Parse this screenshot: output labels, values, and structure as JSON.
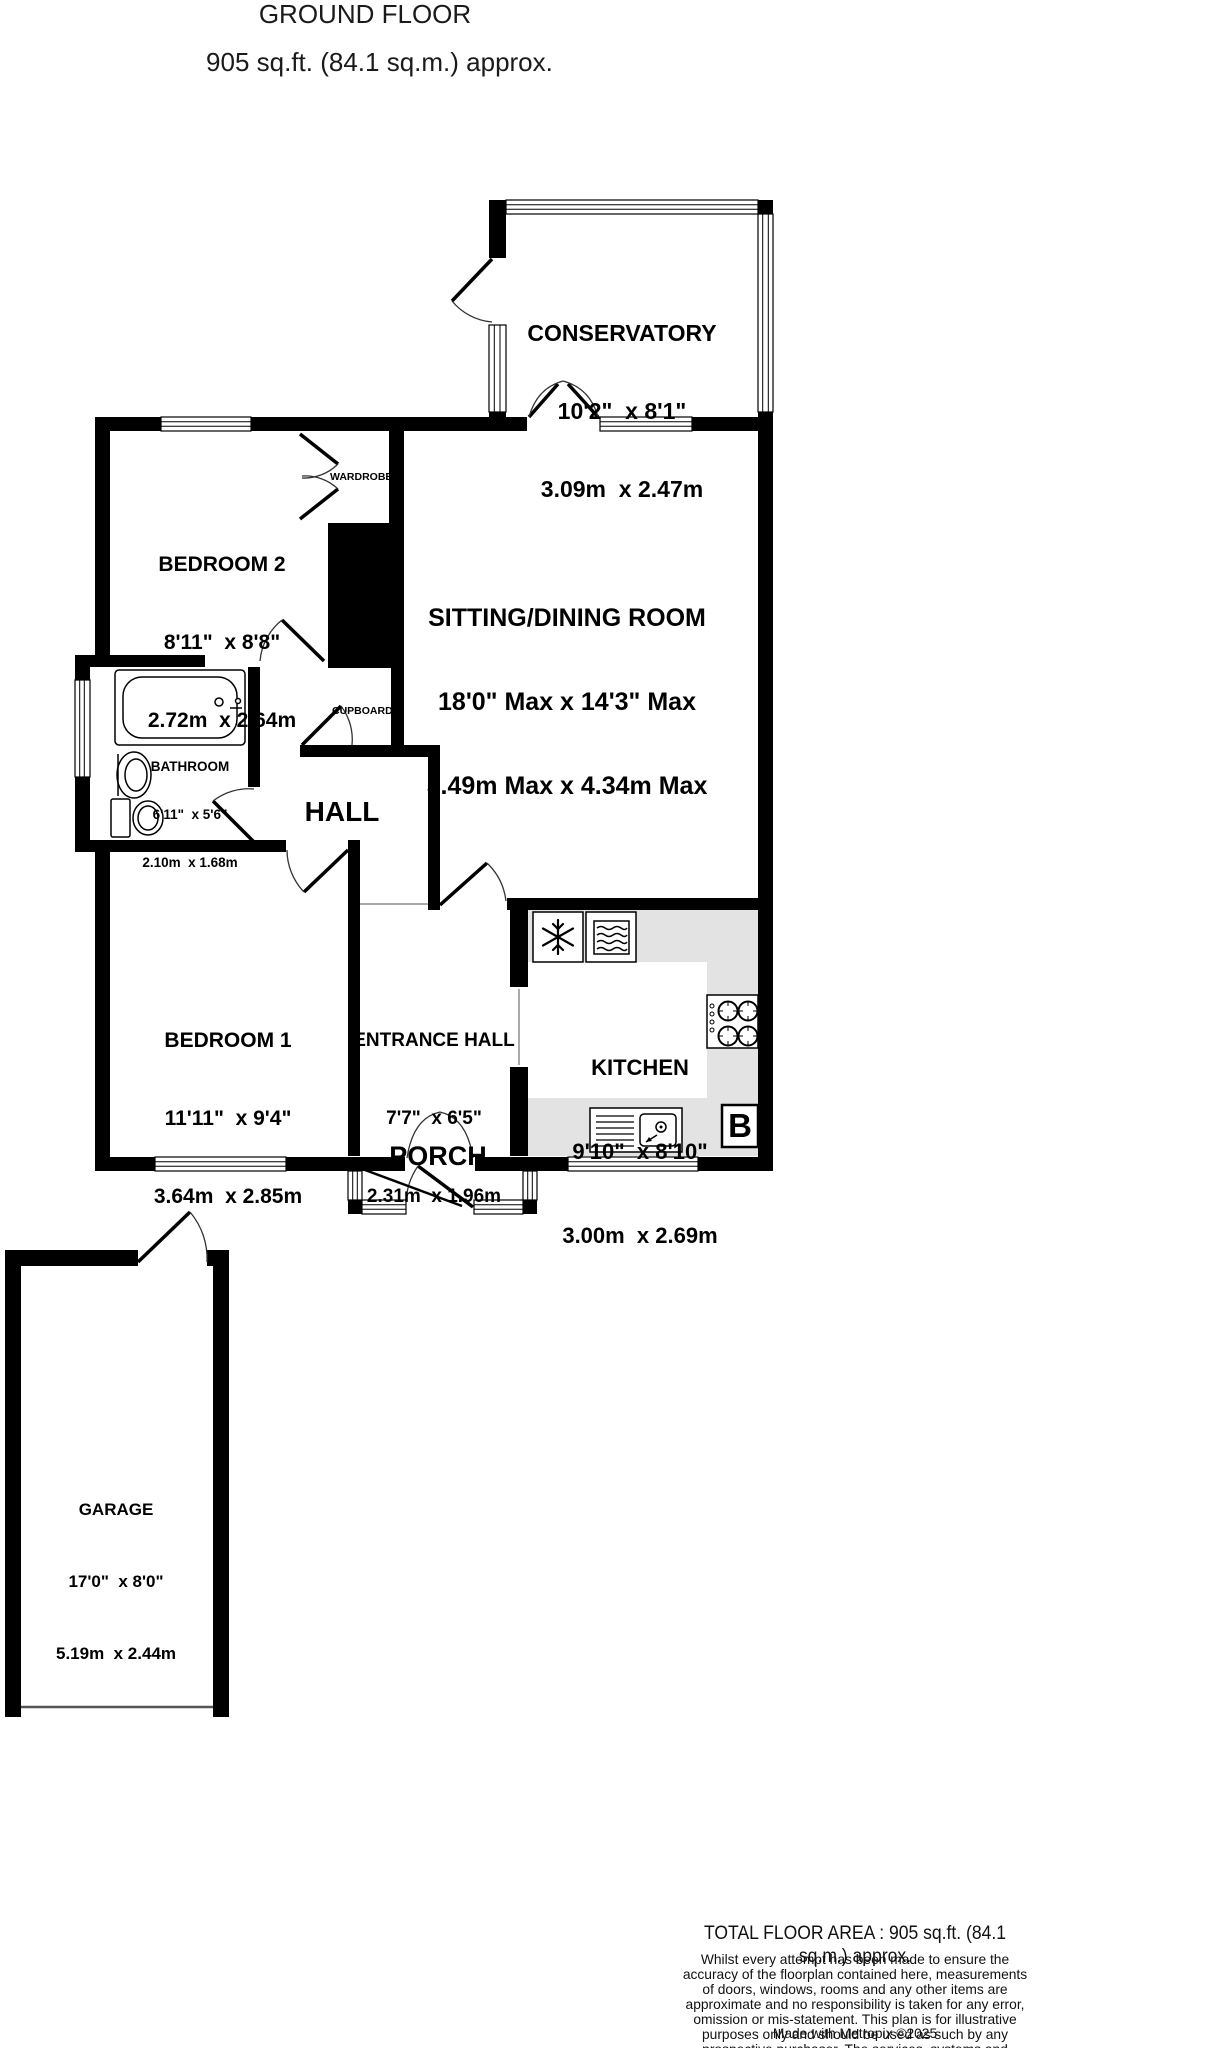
{
  "title": {
    "line1": "GROUND FLOOR",
    "line2": "905 sq.ft. (84.1 sq.m.) approx."
  },
  "rooms": {
    "conservatory": {
      "name": "CONSERVATORY",
      "imperial": "10'2\"  x 8'1\"",
      "metric": "3.09m  x 2.47m"
    },
    "bedroom2": {
      "name": "BEDROOM 2",
      "imperial": "8'11\"  x 8'8\"",
      "metric": "2.72m  x 2.64m"
    },
    "sitting_dining": {
      "name": "SITTING/DINING ROOM",
      "imperial": "18'0\" Max x 14'3\" Max",
      "metric": "5.49m Max x 4.34m Max"
    },
    "bathroom": {
      "name": "BATHROOM",
      "imperial": "6'11\"  x 5'6\"",
      "metric": "2.10m  x 1.68m"
    },
    "hall": {
      "name": "HALL"
    },
    "wardrobe": {
      "name": "WARDROBE"
    },
    "cupboard": {
      "name": "CUPBOARD"
    },
    "bedroom1": {
      "name": "BEDROOM 1",
      "imperial": "11'11\"  x 9'4\"",
      "metric": "3.64m  x 2.85m"
    },
    "entrance_hall": {
      "name": "ENTRANCE HALL",
      "imperial": "7'7\"  x 6'5\"",
      "metric": "2.31m  x 1.96m"
    },
    "kitchen": {
      "name": "KITCHEN",
      "imperial": "9'10\"  x 8'10\"",
      "metric": "3.00m  x 2.69m"
    },
    "porch": {
      "name": "PORCH"
    },
    "garage": {
      "name": "GARAGE",
      "imperial": "17'0\"  x 8'0\"",
      "metric": "5.19m  x 2.44m"
    }
  },
  "symbols": {
    "boiler": "B"
  },
  "icons": [
    "freezer-icon",
    "oven-icon",
    "hob-icon",
    "kitchen-sink-icon",
    "bath-icon",
    "basin-icon",
    "toilet-icon"
  ],
  "footer": {
    "total_area": "TOTAL FLOOR AREA : 905 sq.ft. (84.1 sq.m.) approx.",
    "disclaimer": "Whilst every attempt has been made to ensure the accuracy of the floorplan contained here, measurements\nof doors, windows, rooms and any other items are approximate and no responsibility is taken for any error,\nomission or mis-statement. This plan is for illustrative purposes only and should be used as such by any\nprospective purchaser. The services, systems and appliances shown have not been tested and no guarantee\nas to their operability or efficiency can be given.",
    "credit": "Made with Metropix ©2025"
  },
  "colors": {
    "wall": "#000000",
    "counter": "#e3e3e3",
    "background": "#ffffff"
  }
}
